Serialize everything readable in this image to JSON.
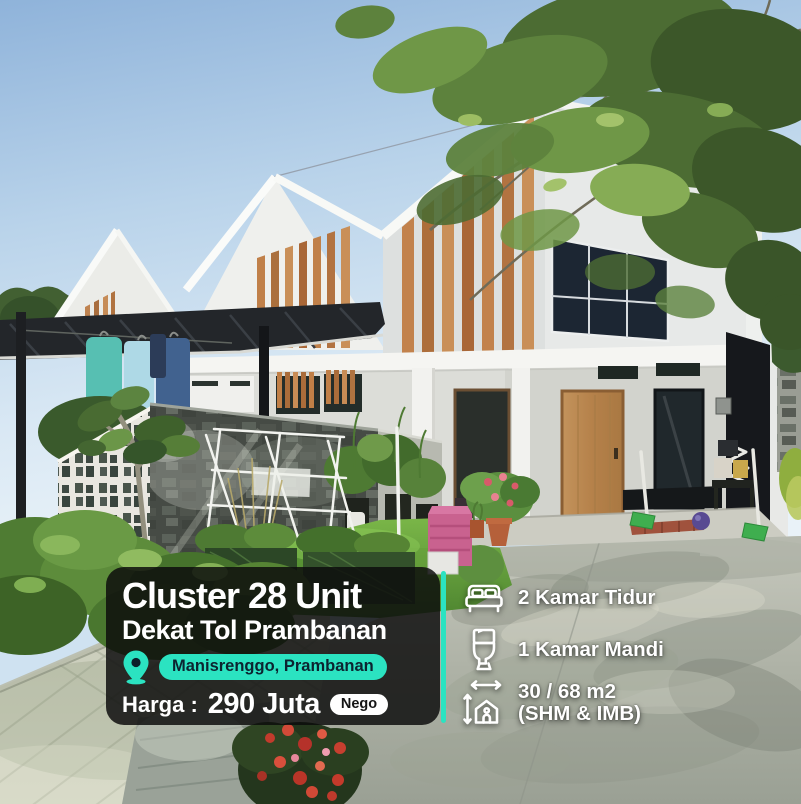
{
  "photo": {
    "alt": "Modern minimalist gable-roof cluster houses with wooden slat accents, carport canopy, breeze-block fence, hanging laundry, garden with drying rack and plants, concrete driveway, blue sky with overhanging tree branches"
  },
  "overlay": {
    "title": "Cluster 28 Unit",
    "subtitle": "Dekat Tol Prambanan",
    "location": {
      "icon": "map-pin-icon",
      "label": "Manisrenggo, Prambanan"
    },
    "price": {
      "label": "Harga :",
      "value": "290 Juta",
      "badge": "Nego"
    }
  },
  "features": [
    {
      "icon": "bed-icon",
      "label": "2 Kamar Tidur"
    },
    {
      "icon": "toilet-icon",
      "label": "1 Kamar Mandi"
    },
    {
      "icon": "house-measure-icon",
      "label": "30 / 68 m2",
      "sublabel": "(SHM & IMB)"
    }
  ],
  "colors": {
    "accent_teal": "#2BE3C1",
    "panel_background": "rgba(12,12,12,0.84)",
    "badge_text": "#0C2430",
    "text": "#FFFFFF",
    "nego_pill": "#FFFFFF"
  }
}
